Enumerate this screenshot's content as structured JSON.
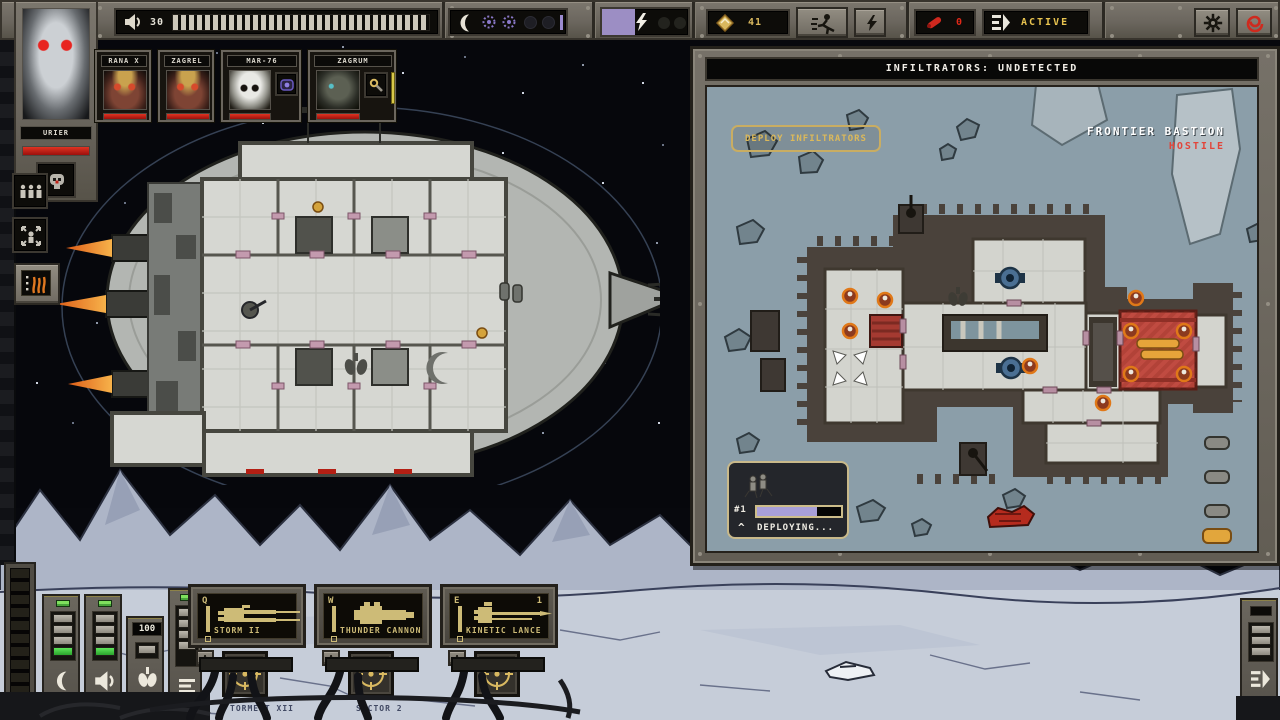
{
  "colors": {
    "accent_gold": "#dcb95a",
    "hostile_red": "#e2453a",
    "purple": "#a89fd8",
    "map_bg": "#8b9ea9",
    "health_red": "#c01d12",
    "green": "#3fd84c"
  },
  "icons": {
    "chevron_up": "^"
  },
  "top_bar": {
    "hull": {
      "value": "30",
      "bar_full": true
    },
    "energy": {
      "fill_style": "width:38%"
    },
    "scrap": {
      "value": "41"
    },
    "missiles": {
      "value": "0"
    },
    "engines": {
      "status": "ACTIVE"
    }
  },
  "crew": {
    "selected": {
      "name": "URIER"
    },
    "members": [
      {
        "name": "RANA X"
      },
      {
        "name": "ZAGREL"
      },
      {
        "name": "MAR-76"
      },
      {
        "name": "ZAGRUM"
      }
    ]
  },
  "map_panel": {
    "header": "INFILTRATORS: UNDETECTED",
    "deploy_button_label": "DEPLOY INFILTRATORS",
    "location": {
      "name": "FRONTIER BASTION",
      "status": "HOSTILE"
    },
    "squad": {
      "id": "#1",
      "status": "DEPLOYING...",
      "progress_style": "width:72%"
    }
  },
  "weapons": [
    {
      "hotkey": "Q",
      "name": "STORM II",
      "assist": "A"
    },
    {
      "hotkey": "W",
      "name": "THUNDER CANNON",
      "assist": "A"
    },
    {
      "hotkey": "E",
      "name": "KINETIC LANCE",
      "assist": "A",
      "count": "1"
    }
  ],
  "gauges": {
    "oxygen_value": "100"
  },
  "footer": {
    "build": "SE 1.1.0A - 2023.11.20 - PN16",
    "title": "TORMENT XII",
    "sector": "SECTOR 2"
  }
}
